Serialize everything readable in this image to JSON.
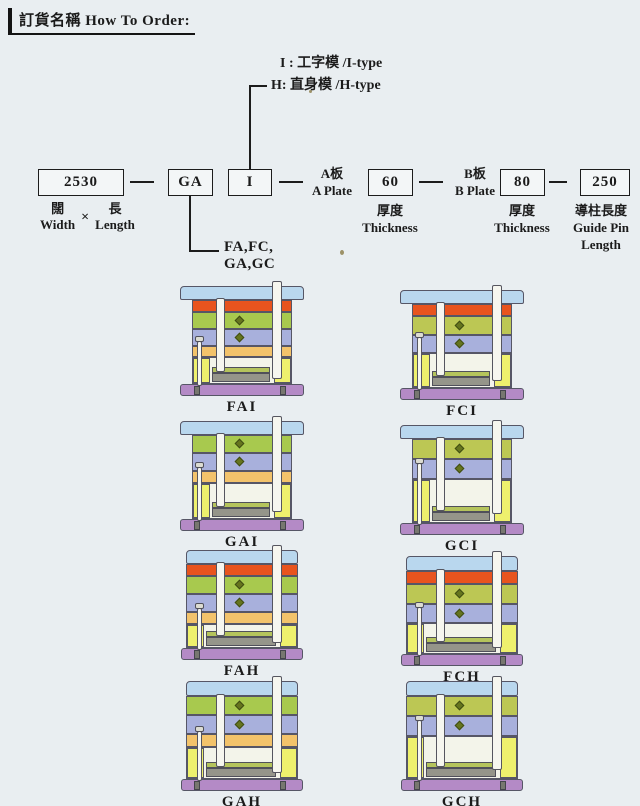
{
  "page": {
    "title_zh": "訂貨名稱",
    "title_en": "How To Order:"
  },
  "type_legend": {
    "i_line": "I : 工字模 /I-type",
    "h_line": "H: 直身模 /H-type"
  },
  "order_code": {
    "size": {
      "value": "2530",
      "zh_left": "闊",
      "multiply": "×",
      "zh_right": "長",
      "en_left": "Width",
      "en_right": "Length"
    },
    "series": {
      "value": "GA",
      "options_line1": "FA,FC,",
      "options_line2": "GA,GC"
    },
    "type": {
      "value": "I"
    },
    "a_plate": {
      "label_zh": "A板",
      "label_en": "A Plate",
      "value": "60",
      "sub_zh": "厚度",
      "sub_en": "Thickness"
    },
    "b_plate": {
      "label_zh": "B板",
      "label_en": "B Plate",
      "value": "80",
      "sub_zh": "厚度",
      "sub_en": "Thickness"
    },
    "guide_pin": {
      "value": "250",
      "sub_zh": "導柱長度",
      "sub_en1": "Guide Pin",
      "sub_en2": "Length"
    }
  },
  "palette": {
    "top": "#b9d7ee",
    "red": "#e8541e",
    "green_a": "#a8c94e",
    "green_c": "#bcc754",
    "blue": "#a8b0dc",
    "support": "#f3c36b",
    "yellow": "#eef06d",
    "base": "#b48ac6"
  },
  "molds": [
    {
      "label": "FAI",
      "type": "I",
      "plates": [
        {
          "name": "top-clamp-plate",
          "color": "top",
          "h": 14
        },
        {
          "name": "upper-clamp-plate",
          "color": "red",
          "h": 12
        },
        {
          "name": "a-plate",
          "color": "green_a",
          "h": 17
        },
        {
          "name": "b-plate",
          "color": "blue",
          "h": 17
        },
        {
          "name": "support-plate",
          "color": "support",
          "h": 11
        },
        {
          "name": "spacer-section",
          "color": "yellow",
          "h": 27
        },
        {
          "name": "base-plate",
          "color": "base",
          "h": 12
        }
      ]
    },
    {
      "label": "FCI",
      "type": "I",
      "plates": [
        {
          "name": "top-clamp-plate",
          "color": "top",
          "h": 14
        },
        {
          "name": "upper-clamp-plate",
          "color": "red",
          "h": 12
        },
        {
          "name": "a-plate",
          "color": "green_c",
          "h": 19
        },
        {
          "name": "b-plate",
          "color": "blue",
          "h": 18
        },
        {
          "name": "spacer-section",
          "color": "yellow",
          "h": 35
        },
        {
          "name": "base-plate",
          "color": "base",
          "h": 12
        }
      ]
    },
    {
      "label": "GAI",
      "type": "I",
      "plates": [
        {
          "name": "top-clamp-plate",
          "color": "top",
          "h": 14
        },
        {
          "name": "a-plate",
          "color": "green_a",
          "h": 18
        },
        {
          "name": "b-plate",
          "color": "blue",
          "h": 18
        },
        {
          "name": "support-plate",
          "color": "support",
          "h": 12
        },
        {
          "name": "spacer-section",
          "color": "yellow",
          "h": 36
        },
        {
          "name": "base-plate",
          "color": "base",
          "h": 12
        }
      ]
    },
    {
      "label": "GCI",
      "type": "I",
      "plates": [
        {
          "name": "top-clamp-plate",
          "color": "top",
          "h": 14
        },
        {
          "name": "a-plate",
          "color": "green_c",
          "h": 20
        },
        {
          "name": "b-plate",
          "color": "blue",
          "h": 20
        },
        {
          "name": "spacer-section",
          "color": "yellow",
          "h": 44
        },
        {
          "name": "base-plate",
          "color": "base",
          "h": 12
        }
      ]
    },
    {
      "label": "FAH",
      "type": "H",
      "plates": [
        {
          "name": "top-clamp-plate",
          "color": "top",
          "h": 14
        },
        {
          "name": "upper-clamp-plate",
          "color": "red",
          "h": 12
        },
        {
          "name": "a-plate",
          "color": "green_a",
          "h": 18
        },
        {
          "name": "b-plate",
          "color": "blue",
          "h": 18
        },
        {
          "name": "support-plate",
          "color": "support",
          "h": 12
        },
        {
          "name": "spacer-section",
          "color": "yellow",
          "h": 24
        },
        {
          "name": "base-plate",
          "color": "base",
          "h": 12
        }
      ]
    },
    {
      "label": "FCH",
      "type": "H",
      "plates": [
        {
          "name": "top-clamp-plate",
          "color": "top",
          "h": 15
        },
        {
          "name": "upper-clamp-plate",
          "color": "red",
          "h": 13
        },
        {
          "name": "a-plate",
          "color": "green_c",
          "h": 20
        },
        {
          "name": "b-plate",
          "color": "blue",
          "h": 19
        },
        {
          "name": "spacer-section",
          "color": "yellow",
          "h": 31
        },
        {
          "name": "base-plate",
          "color": "base",
          "h": 12
        }
      ]
    },
    {
      "label": "GAH",
      "type": "H",
      "plates": [
        {
          "name": "top-clamp-plate",
          "color": "top",
          "h": 15
        },
        {
          "name": "a-plate",
          "color": "green_a",
          "h": 19
        },
        {
          "name": "b-plate",
          "color": "blue",
          "h": 19
        },
        {
          "name": "support-plate",
          "color": "support",
          "h": 13
        },
        {
          "name": "spacer-section",
          "color": "yellow",
          "h": 32
        },
        {
          "name": "base-plate",
          "color": "base",
          "h": 12
        }
      ]
    },
    {
      "label": "GCH",
      "type": "H",
      "plates": [
        {
          "name": "top-clamp-plate",
          "color": "top",
          "h": 15
        },
        {
          "name": "a-plate",
          "color": "green_c",
          "h": 20
        },
        {
          "name": "b-plate",
          "color": "blue",
          "h": 20
        },
        {
          "name": "spacer-section",
          "color": "yellow",
          "h": 43
        },
        {
          "name": "base-plate",
          "color": "base",
          "h": 12
        }
      ]
    }
  ]
}
